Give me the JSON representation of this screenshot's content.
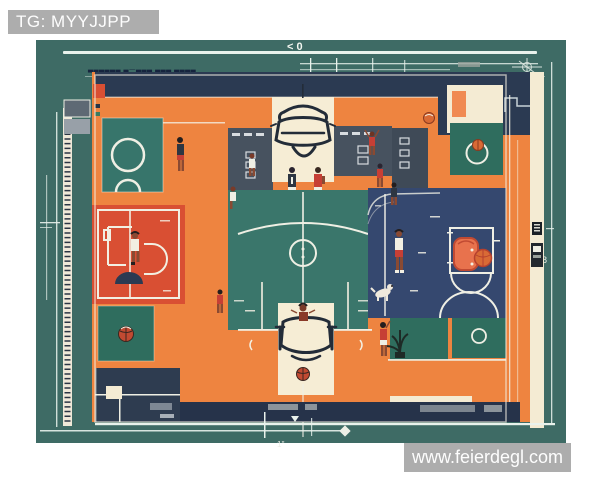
{
  "image": {
    "type": "flat illustration",
    "subject": "Top-down blueprint-style illustration of a basketball court with players"
  },
  "watermarks": {
    "top_left": "TG: MYYJJPP",
    "site": "www.feierdegl.com"
  },
  "blueprint_labels": {
    "top_scale": "< 0",
    "right_measure": "8",
    "bottom_measure": "1''",
    "note": "▃▃▃▃▃▃ ▃—▃▃▃  ▃▃▃ ▃▃▃▃"
  },
  "palette": {
    "background_teal": "#3E6B65",
    "court_orange": "#EE8440",
    "cream": "#F4EBD3",
    "red_court": "#D94F33",
    "navy_court": "#35486F",
    "green_court": "#3A766B",
    "green_square": "#2F6D5E",
    "slate_panel": "#47525F",
    "navy_dark": "#2B3A52",
    "line_white": "#F2EFE2",
    "basketball_orange": "#D96A35",
    "jersey_red": "#C63F35",
    "watermark_gray": "#A7A7A7"
  }
}
